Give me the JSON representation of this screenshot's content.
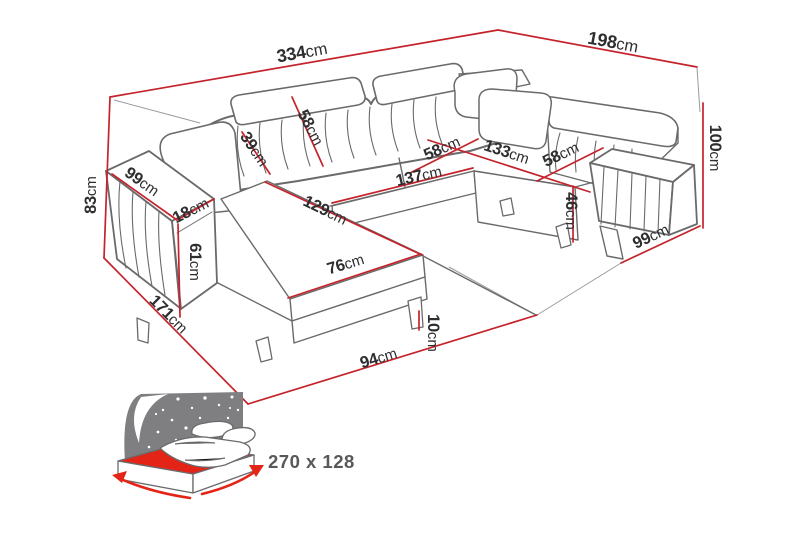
{
  "diagram": {
    "subject": "u-shaped-corner-sofa-dimension-drawing",
    "unit_default": "cm"
  },
  "dimensions": [
    {
      "name": "total-width-top",
      "value": "334",
      "unit": "cm"
    },
    {
      "name": "depth-top-right",
      "value": "198",
      "unit": "cm"
    },
    {
      "name": "height-right",
      "value": "100",
      "unit": "cm"
    },
    {
      "name": "height-left",
      "value": "83",
      "unit": "cm"
    },
    {
      "name": "left-armrest-length",
      "value": "99",
      "unit": "cm"
    },
    {
      "name": "left-armrest-width",
      "value": "18",
      "unit": "cm"
    },
    {
      "name": "left-armrest-front-height",
      "value": "61",
      "unit": "cm"
    },
    {
      "name": "chaise-outer-length",
      "value": "171",
      "unit": "cm"
    },
    {
      "name": "left-backrest-depth",
      "value": "39",
      "unit": "cm"
    },
    {
      "name": "left-backrest-width",
      "value": "58",
      "unit": "cm"
    },
    {
      "name": "middle-seat-depth",
      "value": "58",
      "unit": "cm"
    },
    {
      "name": "corner-back-width",
      "value": "133",
      "unit": "cm"
    },
    {
      "name": "right-seat-depth",
      "value": "58",
      "unit": "cm"
    },
    {
      "name": "middle-seat-length",
      "value": "137",
      "unit": "cm"
    },
    {
      "name": "chaise-inner-length",
      "value": "129",
      "unit": "cm"
    },
    {
      "name": "chaise-front-width",
      "value": "76",
      "unit": "cm"
    },
    {
      "name": "seat-height",
      "value": "46",
      "unit": "cm"
    },
    {
      "name": "right-armrest-length",
      "value": "99",
      "unit": "cm"
    },
    {
      "name": "front-edge-width",
      "value": "94",
      "unit": "cm"
    },
    {
      "name": "leg-height",
      "value": "10",
      "unit": "cm"
    }
  ],
  "sleeping_area": {
    "label": "270 x 128",
    "icon": "sofa-bed-sleeping-surface-icon"
  },
  "colors": {
    "dimension_red": "#c5232b",
    "bed_red": "#e32417",
    "line_gray": "#6a6a6c",
    "light_gray": "#9b9b9d",
    "text_dark": "#2e2e30",
    "headboard_gray": "#7f7f81",
    "label_gray": "#58585a"
  }
}
